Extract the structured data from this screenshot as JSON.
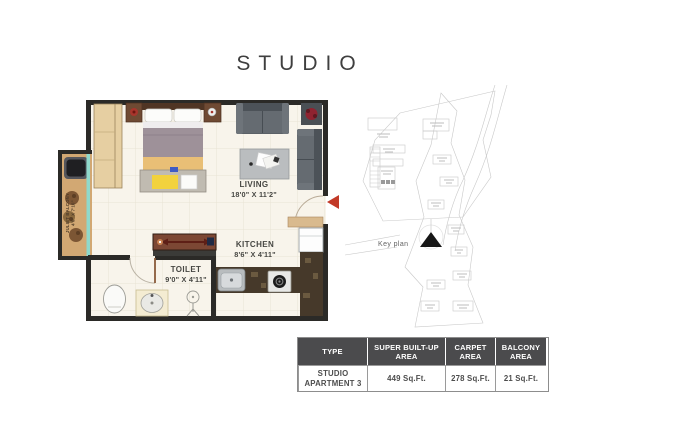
{
  "title": "STUDIO",
  "plan": {
    "rooms": {
      "living": {
        "name": "LIVING",
        "dims": "18'0\" X 11'2\""
      },
      "kitchen": {
        "name": "KITCHEN",
        "dims": "8'6\" X 4'11\""
      },
      "toilet": {
        "name": "TOILET",
        "dims": "9'0\" X 4'11\""
      },
      "balcony": {
        "name": "JULIET BALCONY",
        "dims": "4'0\" X 7'10\""
      }
    },
    "colors": {
      "wall": "#2b2a27",
      "floor": "#f8f4eb",
      "wood": "#d2a873",
      "marble": "#46392a",
      "entry_arrow": "#c23a28",
      "window_teal": "#8fd9cb"
    }
  },
  "keyplan": {
    "label": "Key plan"
  },
  "area_table": {
    "headers": [
      "TYPE",
      "SUPER BUILT-UP AREA",
      "CARPET AREA",
      "BALCONY AREA"
    ],
    "row": {
      "type": "STUDIO APARTMENT 3",
      "super_builtup": "449 Sq.Ft.",
      "carpet": "278 Sq.Ft.",
      "balcony": "21 Sq.Ft."
    },
    "header_bg": "#4b4b4d"
  }
}
